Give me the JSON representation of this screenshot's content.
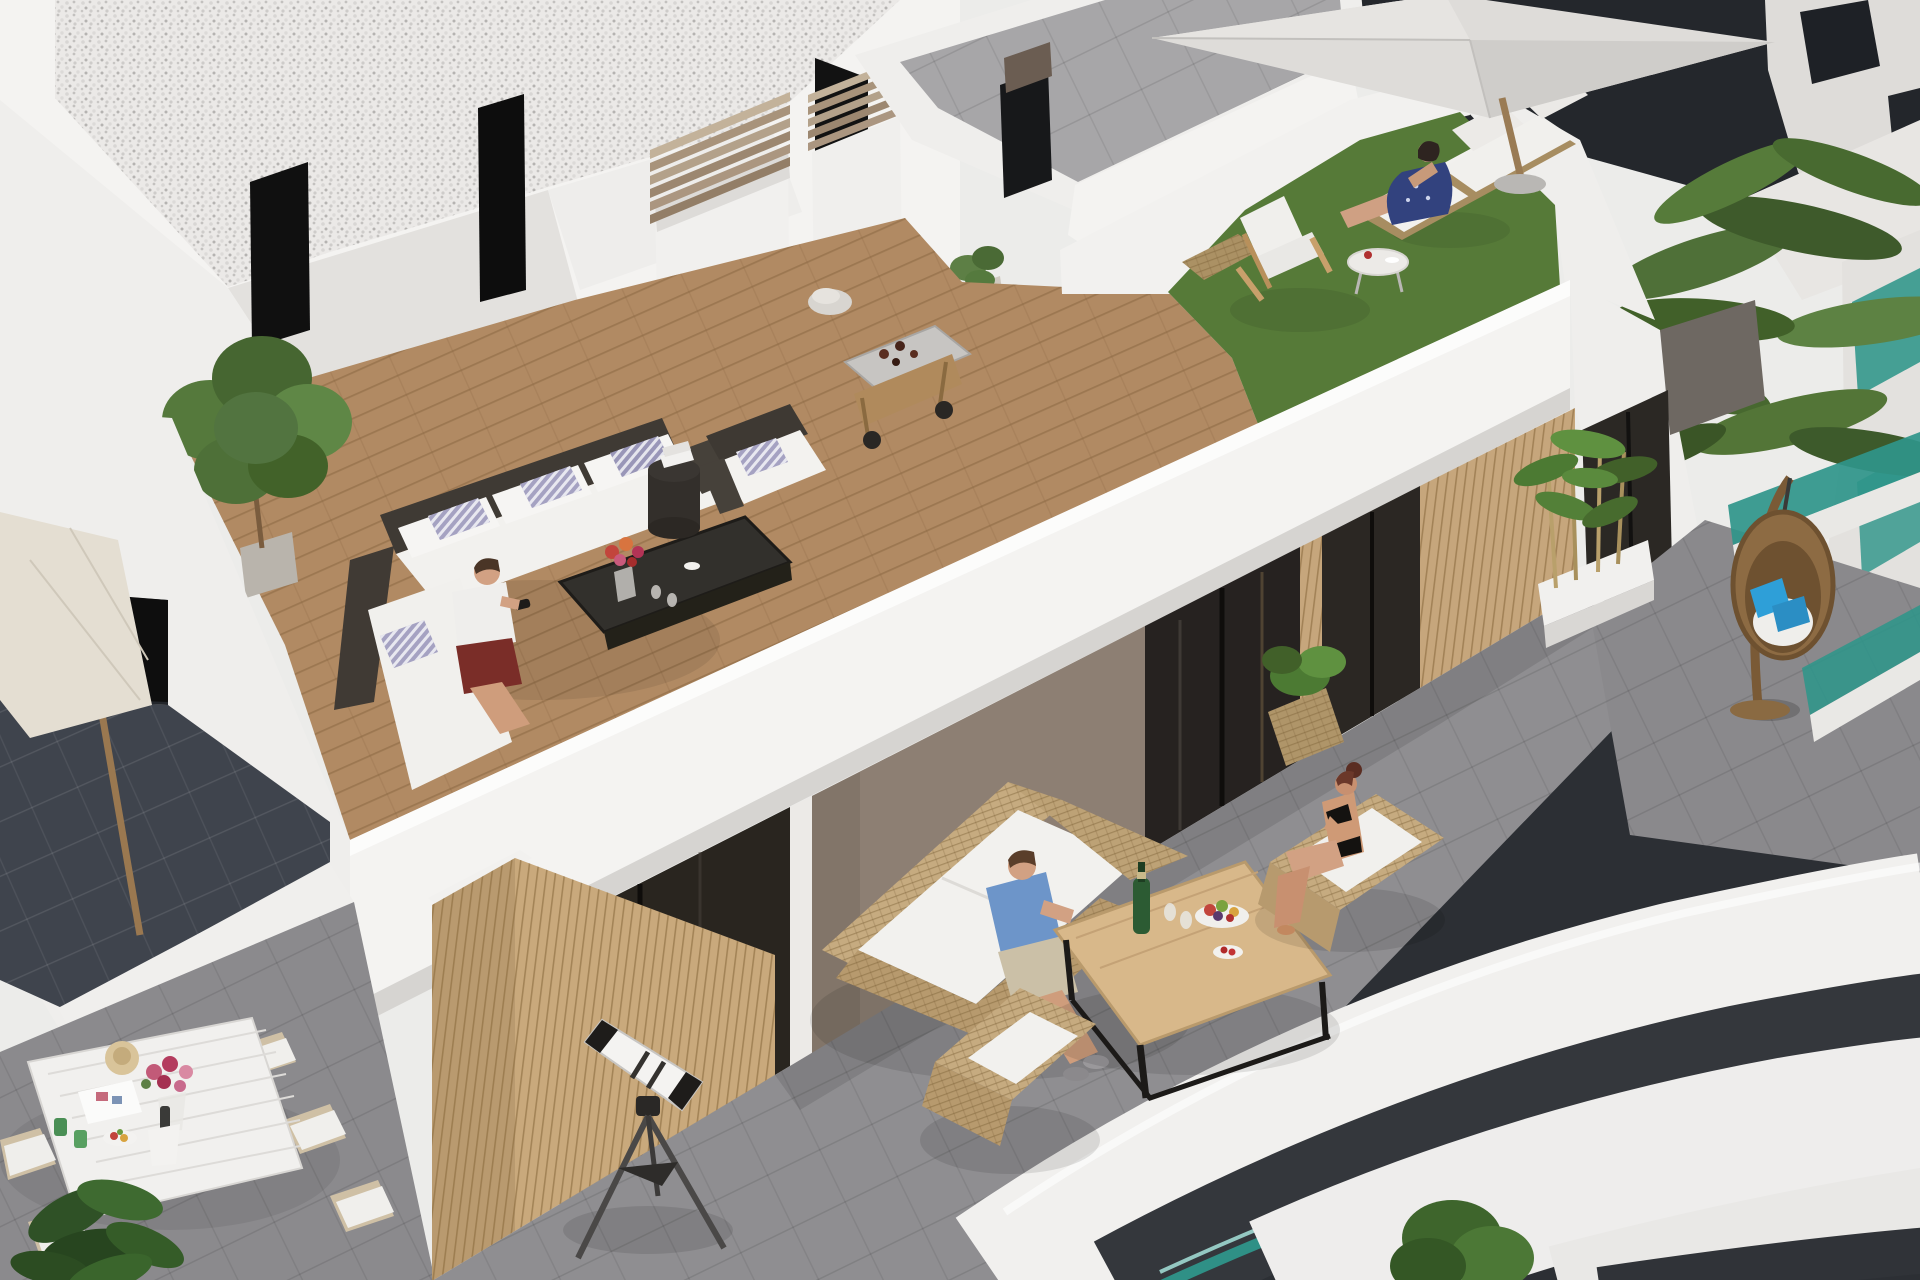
{
  "meta": {
    "type": "architectural-3d-render",
    "view": "aerial-oblique",
    "subject": "Modern white apartment building penthouse with two terrace levels, outdoor furniture and four residents",
    "time_of_day": "daylight"
  },
  "palette": {
    "bg": "#ececea",
    "white_bright": "#f4f3f1",
    "white_mid": "#eceae8",
    "white_shade": "#e3e1de",
    "white_dim": "#d6d4d1",
    "gravel_base": "#ebe9e7",
    "deck_wood": "#b18a63",
    "deck_line": "#8a6742",
    "slat_wood": "#c6a67c",
    "slat_line": "#96743f",
    "taupe_wall": "#8d7f73",
    "glass_dark": "#29251f",
    "grass": "#567a38",
    "grass_dark": "#47652f",
    "tile_floor": "#8f8e91",
    "tile_light": "#a7a6a8",
    "tile_dark_balcony": "#3f444d",
    "dark_building": "#24272c",
    "dark_corner": "#2c2f34",
    "teal_glass": "#2f958a",
    "teal_light": "#9fd8d0",
    "rattan_dark": "#3f3a34",
    "rattan_light": "#c6ab80",
    "cushion_white": "#f2f1ee",
    "pillow_lavender": "#a5a2c2",
    "egg_rattan": "#8d6b43",
    "blue_pillow": "#2e9fd8",
    "bronze_grille": "#a8937b",
    "parasol_canopy": "#dedcd9",
    "parasol_cream": "#e4ded2",
    "palm_green": "#4f7038",
    "skin": "#cf9d7c",
    "shirt_blue": "#6d95c9",
    "shorts_maroon": "#7a2d28",
    "bottle_green": "#2c5b33"
  },
  "scene": {
    "rooftop": {
      "label": "rooftop level",
      "elements": [
        "white gravel ballast roof",
        "white penthouse volumes with dark doorways",
        "two chimneys with bronze slat grilles",
        "inner courtyard with grey tiles",
        "stone pot plant"
      ]
    },
    "upper_terrace": {
      "label": "upper terrace (wood deck)",
      "elements": [
        "fiddle-leaf fig tree in pot",
        "dark rattan L-sofa with white cushions and lavender striped pillows",
        "man in white t-shirt with game controller",
        "dark wicker coffee table with flowers and coffee",
        "round side table with books",
        "dark rattan armchair",
        "barbecue grill cart",
        "decorative rock"
      ]
    },
    "grass_lounge": {
      "label": "artificial grass lounge",
      "elements": [
        "two rattan sun loungers with white pads",
        "woman in blue floral dress",
        "white round side table with drinks",
        "low wooden deck chair",
        "rattan storage box",
        "large square parasol with wooden pole"
      ]
    },
    "lower_terrace": {
      "label": "lower terrace (grey tiles)",
      "elements": [
        "light rattan two-seat sofa",
        "man in blue t-shirt",
        "rattan armchair with woman in black bikini",
        "empty rattan armchair",
        "oak coffee table with wine bottle, glasses, fruit bowl, strawberry plate",
        "white reflector telescope on tripod",
        "wood slat clad column",
        "taupe wall panels and dark glass sliding doors",
        "wicker planter",
        "bamboo in white planter"
      ]
    },
    "right_balcony": {
      "label": "side balcony",
      "elements": [
        "hanging rattan egg chair with blue pillows",
        "teal glass railing",
        "palm trees"
      ]
    },
    "left_neighbor": {
      "label": "neighbouring balconies (left)",
      "elements": [
        "cream parasol",
        "dark tiled balcony with black door",
        "white slatted dining table",
        "six cream dining chairs",
        "straw hat, magazine, tulip vase, drink cans, ice bucket with wine",
        "rubber plant"
      ]
    },
    "bottom_right": {
      "label": "stacked curved balconies (lower right)",
      "elements": [
        "white curved parapet bands",
        "dark tile floors",
        "teal glass railings",
        "green shrub"
      ]
    },
    "backdrop": {
      "label": "surrounding buildings",
      "elements": [
        "dark building top right",
        "white building with dark windows",
        "white building with teal glass balconies",
        "palm tree cluster"
      ]
    }
  },
  "people": [
    {
      "id": "man-deck",
      "desc": "man in white t-shirt and maroon shorts seated on upper-deck sofa holding a controller"
    },
    {
      "id": "woman-lounger",
      "desc": "woman in dark blue floral dress seated on sun lounger on the grass"
    },
    {
      "id": "man-blue",
      "desc": "man in blue t-shirt and khaki shorts on lower-terrace rattan sofa"
    },
    {
      "id": "woman-bikini",
      "desc": "woman in black bikini with hair bun seated in rattan armchair"
    }
  ]
}
